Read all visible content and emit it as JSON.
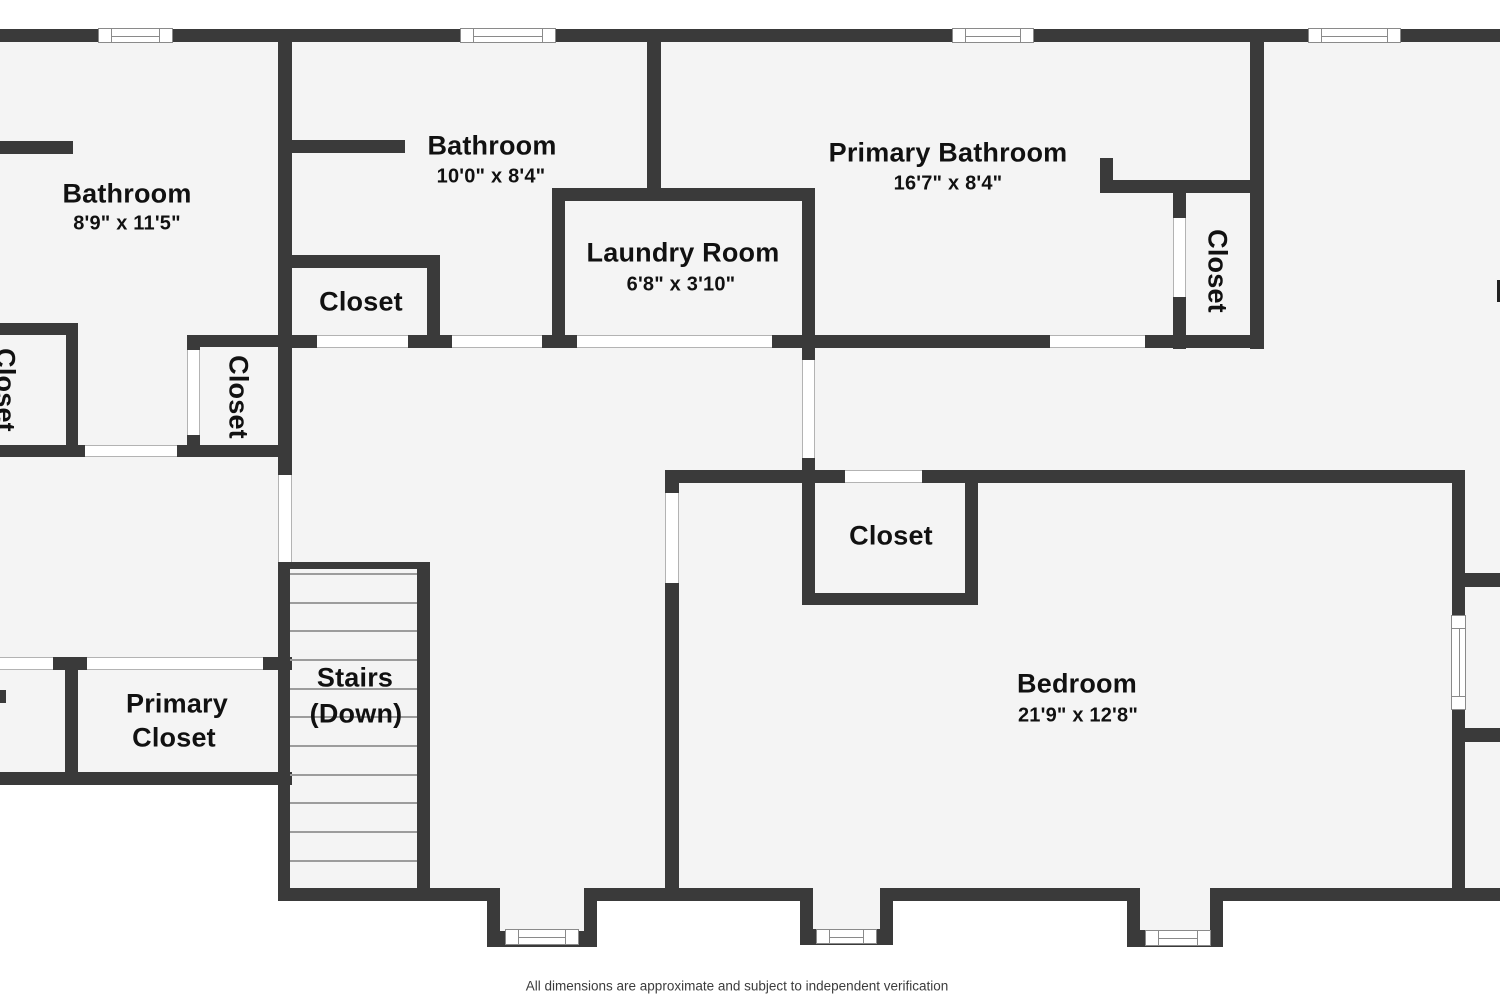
{
  "title": "Floor plan",
  "colors": {
    "wall": "#3a3a3a",
    "floor": "#f4f4f4",
    "background": "#ffffff",
    "door_frame": "#b3b3b3",
    "window_frame": "#8a8a8a",
    "label_text": "#111111",
    "footer_text": "#3c3c3c"
  },
  "rooms": {
    "bathroom_left": {
      "name": "Bathroom",
      "dimensions": "8'9\" x 11'5\""
    },
    "bathroom_top": {
      "name": "Bathroom",
      "dimensions": "10'0\" x 8'4\""
    },
    "primary_bathroom": {
      "name": "Primary Bathroom",
      "dimensions": "16'7\" x 8'4\""
    },
    "laundry_room": {
      "name": "Laundry Room",
      "dimensions": "6'8\" x 3'10\""
    },
    "bedroom": {
      "name": "Bedroom",
      "dimensions": "21'9\" x 12'8\""
    },
    "stairs": {
      "name": "Stairs",
      "sub": "(Down)"
    },
    "primary_closet": {
      "line1": "Primary",
      "line2": "Closet"
    },
    "closet_top_middle": {
      "name": "Closet"
    },
    "closet_left_edge": {
      "name": "Closet"
    },
    "closet_middle": {
      "name": "Closet"
    },
    "closet_primary_bath": {
      "name": "Closet"
    },
    "closet_bedroom": {
      "name": "Closet"
    }
  },
  "footer": "All dimensions are approximate and subject to independent verification"
}
